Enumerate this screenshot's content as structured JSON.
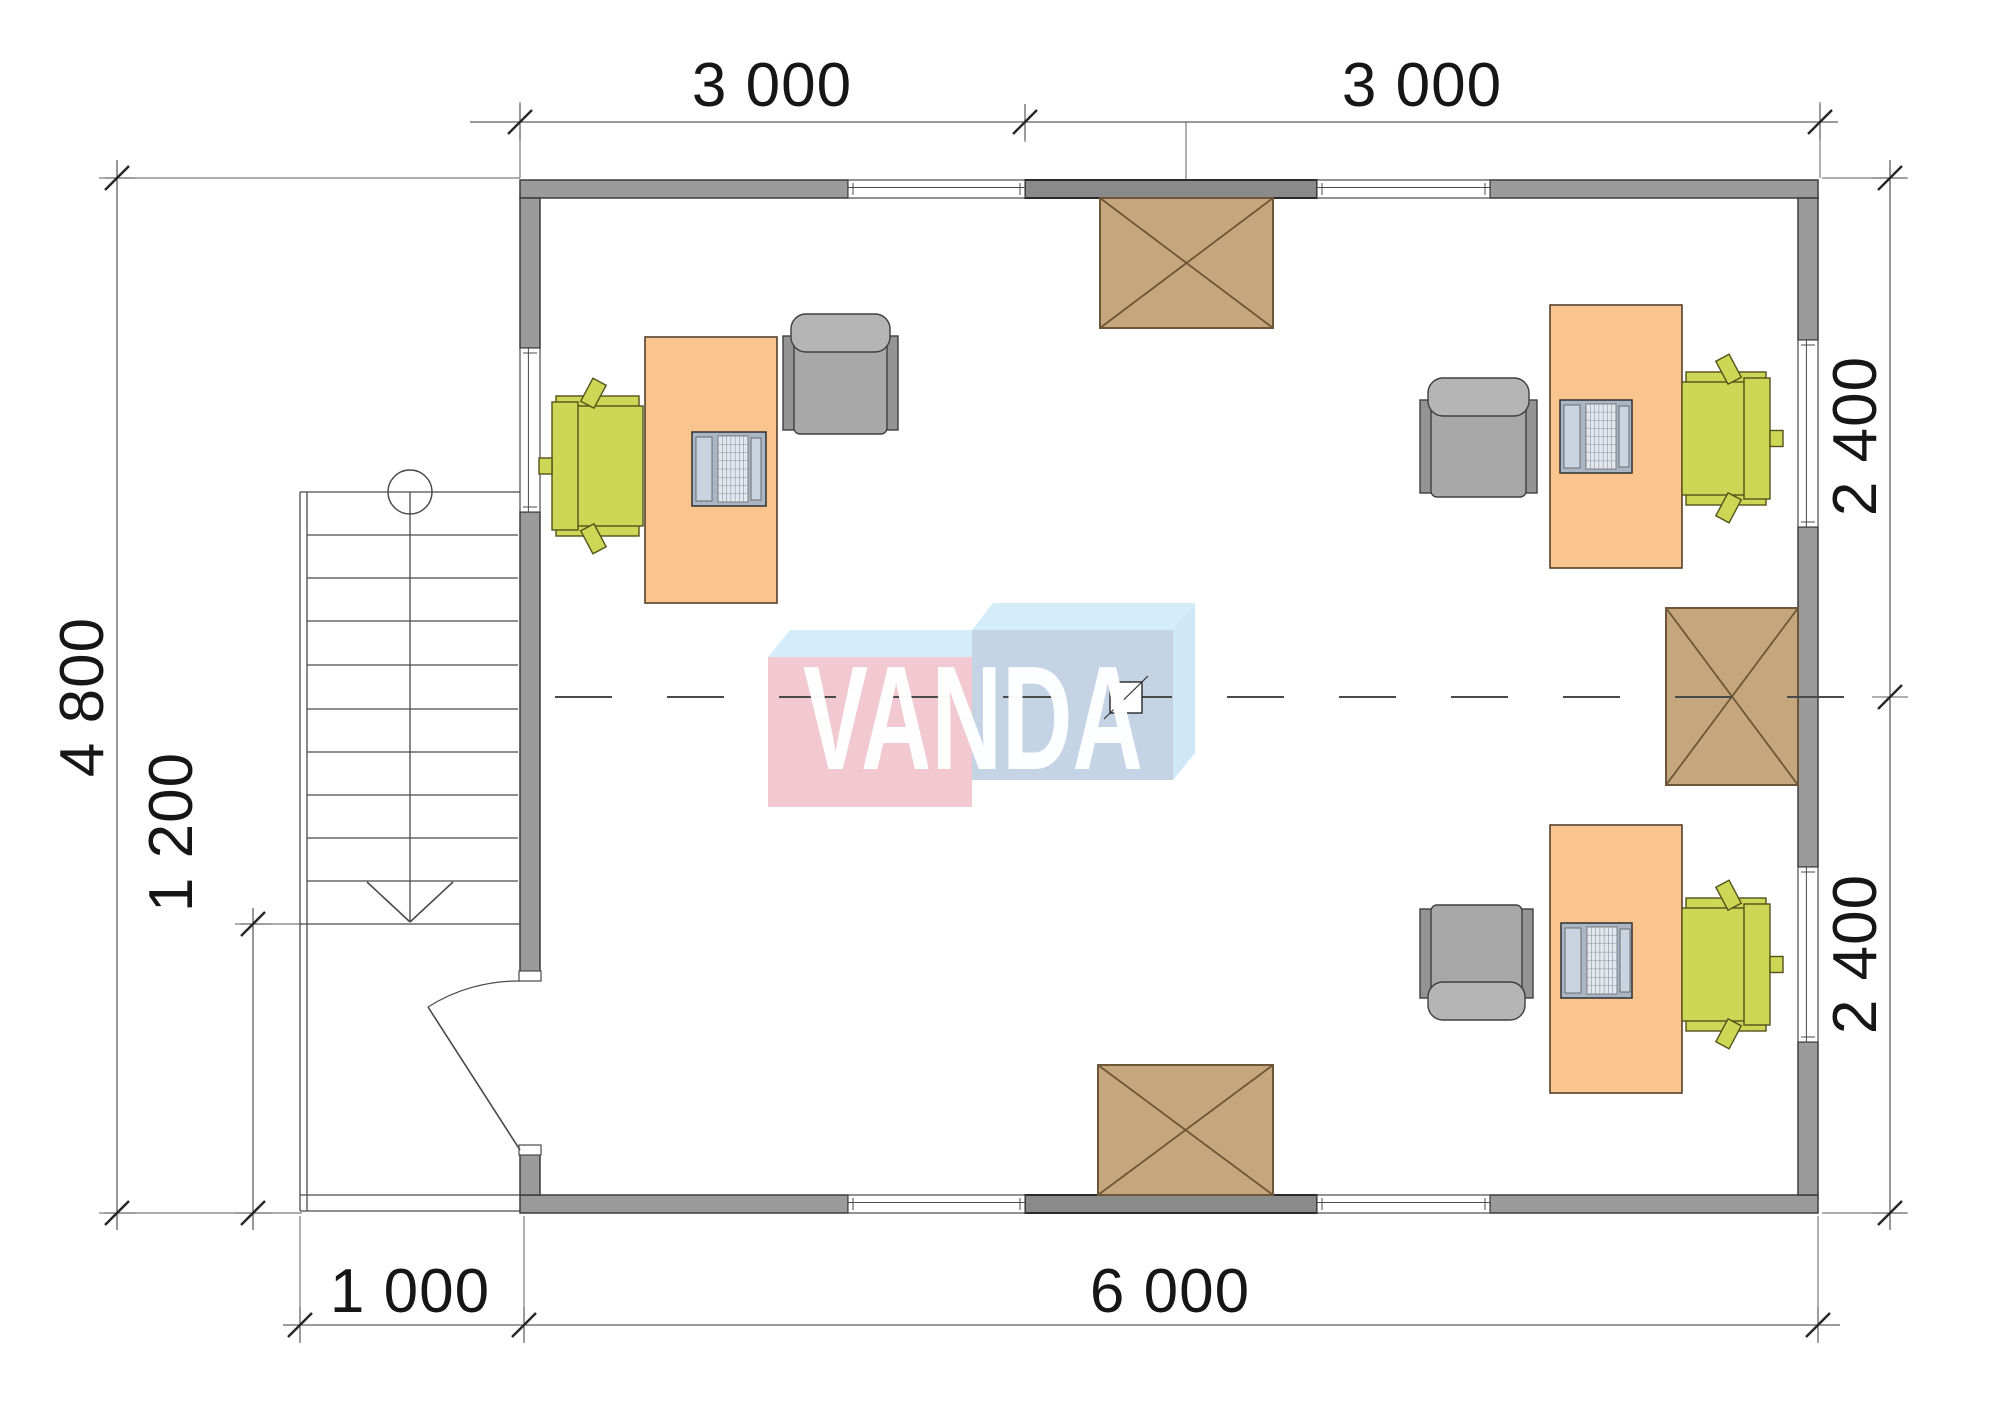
{
  "page": {
    "title": "Office floor plan"
  },
  "watermark": {
    "text": "VANDA"
  },
  "dimensions": {
    "top_left": "3 000",
    "top_right": "3 000",
    "bottom_porch": "1 000",
    "bottom_main": "6 000",
    "left_total": "4 800",
    "left_porch": "1 200",
    "right_upper": "2 400",
    "right_lower": "2 400"
  },
  "palette": {
    "wall": "#9b9b9b",
    "wall_dark": "#8a8a8a",
    "wall_stroke": "#3c3c3c",
    "wall_dark_stroke": "#2a2a2a",
    "thin_line": "#4a4a4a",
    "ext_line": "#7a7a7a",
    "dim_line": "#5f5f5f",
    "tick": "#262626",
    "desk_fill": "#f9c48e",
    "desk_stroke": "#54402a",
    "chair_fill": "#ccd755",
    "chair_stroke": "#55511c",
    "armchair_body": "#a8a8a8",
    "armchair_back": "#b5b5b5",
    "armchair_arm": "#949494",
    "armchair_stroke": "#3f3f3f",
    "box_fill": "#c6a67c",
    "box_stroke": "#6e5639",
    "laptop_body": "#aab6c6",
    "laptop_screen": "#c9d4e0",
    "laptop_key": "#e3e8ee",
    "laptop_stroke": "#2e2e2e",
    "logo_pink": "#f2c9d1",
    "logo_blue_front": "#c5d4e4",
    "logo_top": "#d5ecfa",
    "logo_side": "#cfe7f7"
  },
  "geometry": {
    "walls": [
      {
        "x": 520,
        "y": 180,
        "w": 328,
        "h": 18,
        "dark": false
      },
      {
        "x": 1025,
        "y": 180,
        "w": 292,
        "h": 18,
        "dark": true
      },
      {
        "x": 1490,
        "y": 180,
        "w": 328,
        "h": 18,
        "dark": false
      },
      {
        "x": 520,
        "y": 1195,
        "w": 328,
        "h": 18,
        "dark": false
      },
      {
        "x": 1025,
        "y": 1195,
        "w": 292,
        "h": 18,
        "dark": true
      },
      {
        "x": 1490,
        "y": 1195,
        "w": 328,
        "h": 18,
        "dark": false
      },
      {
        "x": 520,
        "y": 198,
        "w": 20,
        "h": 150,
        "dark": false
      },
      {
        "x": 520,
        "y": 512,
        "w": 20,
        "h": 460,
        "dark": false
      },
      {
        "x": 520,
        "y": 1154,
        "w": 20,
        "h": 41,
        "dark": false
      },
      {
        "x": 1798,
        "y": 198,
        "w": 20,
        "h": 142,
        "dark": false
      },
      {
        "x": 1798,
        "y": 527,
        "w": 20,
        "h": 340,
        "dark": false
      },
      {
        "x": 1798,
        "y": 1042,
        "w": 20,
        "h": 153,
        "dark": false
      }
    ],
    "windows": [
      {
        "x": 848,
        "y": 180,
        "w": 177,
        "h": 18,
        "o": "h"
      },
      {
        "x": 1317,
        "y": 180,
        "w": 173,
        "h": 18,
        "o": "h"
      },
      {
        "x": 848,
        "y": 1195,
        "w": 177,
        "h": 18,
        "o": "h"
      },
      {
        "x": 1317,
        "y": 1195,
        "w": 173,
        "h": 18,
        "o": "h"
      },
      {
        "x": 520,
        "y": 348,
        "w": 20,
        "h": 164,
        "o": "v"
      },
      {
        "x": 1798,
        "y": 340,
        "w": 20,
        "h": 187,
        "o": "v"
      },
      {
        "x": 1798,
        "y": 867,
        "w": 20,
        "h": 175,
        "o": "v"
      }
    ],
    "boxes": [
      {
        "x": 1100,
        "y": 198,
        "w": 173,
        "h": 130
      },
      {
        "x": 1666,
        "y": 608,
        "w": 132,
        "h": 177
      },
      {
        "x": 1098,
        "y": 1065,
        "w": 175,
        "h": 130
      }
    ],
    "desks": [
      {
        "x": 645,
        "y": 337,
        "w": 132,
        "h": 266
      },
      {
        "x": 1550,
        "y": 305,
        "w": 132,
        "h": 263
      },
      {
        "x": 1550,
        "y": 825,
        "w": 132,
        "h": 268
      }
    ],
    "laptops": [
      {
        "x": 692,
        "y": 432,
        "w": 74,
        "h": 74
      },
      {
        "x": 1560,
        "y": 400,
        "w": 72,
        "h": 73
      },
      {
        "x": 1561,
        "y": 923,
        "w": 71,
        "h": 75
      }
    ],
    "armchairs": [
      {
        "x": 783,
        "y": 314,
        "w": 115,
        "h": 120,
        "facing": "down"
      },
      {
        "x": 1420,
        "y": 378,
        "w": 117,
        "h": 119,
        "facing": "down"
      },
      {
        "x": 1420,
        "y": 905,
        "w": 113,
        "h": 115,
        "facing": "up"
      }
    ],
    "chairs": [
      {
        "x": 552,
        "y": 396,
        "w": 91,
        "h": 140,
        "facing": "right"
      },
      {
        "x": 1682,
        "y": 372,
        "w": 88,
        "h": 133,
        "facing": "left"
      },
      {
        "x": 1682,
        "y": 898,
        "w": 88,
        "h": 133,
        "facing": "left"
      }
    ],
    "stairs": {
      "lines": [
        [
          300,
          492,
          300,
          1211
        ],
        [
          307,
          492,
          307,
          1211
        ],
        [
          300,
          492,
          520,
          492
        ],
        [
          300,
          924,
          520,
          924
        ],
        [
          307,
          535,
          518,
          535
        ],
        [
          307,
          578,
          518,
          578
        ],
        [
          307,
          621,
          518,
          621
        ],
        [
          307,
          665,
          518,
          665
        ],
        [
          307,
          709,
          518,
          709
        ],
        [
          307,
          752,
          518,
          752
        ],
        [
          307,
          795,
          518,
          795
        ],
        [
          307,
          838,
          518,
          838
        ],
        [
          307,
          881,
          518,
          881
        ],
        [
          410,
          492,
          410,
          921
        ],
        [
          300,
          1195,
          520,
          1195
        ],
        [
          300,
          1211,
          520,
          1211
        ]
      ],
      "arrow": [
        [
          367,
          882,
          410,
          922
        ],
        [
          453,
          882,
          410,
          922
        ]
      ],
      "circle": {
        "cx": 410,
        "cy": 492,
        "r": 22
      }
    },
    "door": {
      "jambs": [
        {
          "x": 519,
          "y": 971,
          "w": 22,
          "h": 10
        },
        {
          "x": 519,
          "y": 1145,
          "w": 22,
          "h": 10
        }
      ],
      "leaf": [
        520,
        1150,
        428,
        1007
      ],
      "arc": "M 520 981 A 169 169 0 0 0 428 1007"
    },
    "dim_lines": [
      [
        470,
        122,
        1838,
        122
      ],
      [
        283,
        1325,
        1840,
        1325
      ],
      [
        117,
        160,
        117,
        1230
      ],
      [
        253,
        908,
        253,
        1230
      ],
      [
        1890,
        160,
        1890,
        1230
      ]
    ],
    "ext_lines": [
      [
        520,
        102,
        520,
        178
      ],
      [
        1025,
        104,
        1025,
        142
      ],
      [
        1186,
        122,
        1186,
        179
      ],
      [
        1820,
        102,
        1820,
        178
      ],
      [
        105,
        178,
        520,
        178
      ],
      [
        1822,
        178,
        1906,
        178
      ],
      [
        1822,
        1213,
        1906,
        1213
      ],
      [
        105,
        1213,
        302,
        1213
      ],
      [
        240,
        924,
        302,
        924
      ],
      [
        300,
        1216,
        300,
        1342
      ],
      [
        524,
        1216,
        524,
        1342
      ],
      [
        1818,
        1216,
        1818,
        1342
      ]
    ],
    "ticks_h": [
      [
        520,
        122
      ],
      [
        1025,
        122
      ],
      [
        1820,
        122
      ],
      [
        300,
        1325
      ],
      [
        524,
        1325
      ],
      [
        1818,
        1325
      ]
    ],
    "ticks_v": [
      [
        117,
        178
      ],
      [
        117,
        1213
      ],
      [
        253,
        924
      ],
      [
        253,
        1213
      ],
      [
        1890,
        178
      ],
      [
        1890,
        697
      ],
      [
        1890,
        1213
      ]
    ],
    "centerline": {
      "x1": 555,
      "y": 697,
      "x2": 1890,
      "dash": "57 55"
    },
    "axis_marker": {
      "x": 1110,
      "y": 682,
      "w": 32,
      "h": 31,
      "diag": [
        1104,
        719,
        1148,
        676
      ]
    },
    "logo": {
      "pink_front": [
        768,
        657,
        204,
        150
      ],
      "blue_front": [
        972,
        630,
        201,
        150
      ],
      "pink_top": [
        [
          768,
          657
        ],
        [
          972,
          657
        ],
        [
          993,
          630
        ],
        [
          790,
          630
        ]
      ],
      "blue_top": [
        [
          972,
          630
        ],
        [
          1173,
          630
        ],
        [
          1195,
          603
        ],
        [
          993,
          603
        ]
      ],
      "blue_side": [
        [
          1173,
          630
        ],
        [
          1195,
          603
        ],
        [
          1195,
          753
        ],
        [
          1173,
          780
        ]
      ]
    }
  }
}
